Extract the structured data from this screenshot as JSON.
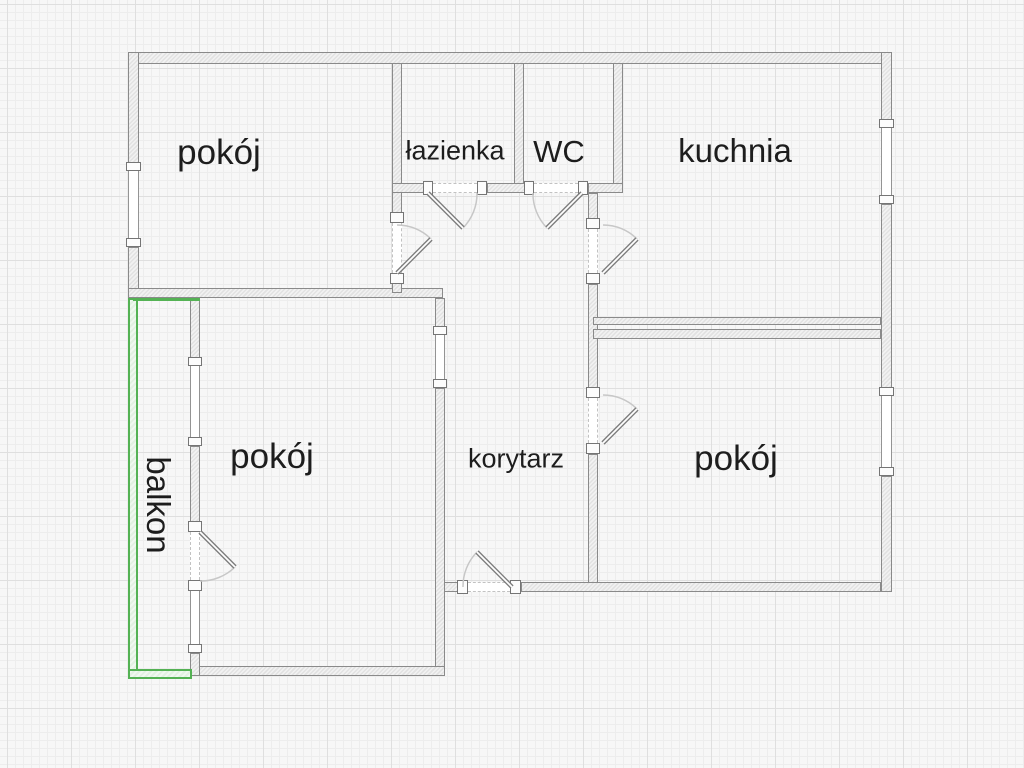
{
  "floorplan": {
    "rooms": [
      {
        "id": "room-top-left",
        "label": "pokój"
      },
      {
        "id": "bathroom",
        "label": "łazienka"
      },
      {
        "id": "wc",
        "label": "WC"
      },
      {
        "id": "kitchen",
        "label": "kuchnia"
      },
      {
        "id": "room-bottom-left",
        "label": "pokój"
      },
      {
        "id": "corridor",
        "label": "korytarz"
      },
      {
        "id": "room-bottom-right",
        "label": "pokój"
      },
      {
        "id": "balcony",
        "label": "balkon"
      }
    ],
    "colors": {
      "background": "#f7f7f7",
      "wall_edge": "#8a8a8a",
      "balcony_outline": "#54b254",
      "label_text": "#1d1d1d"
    }
  }
}
